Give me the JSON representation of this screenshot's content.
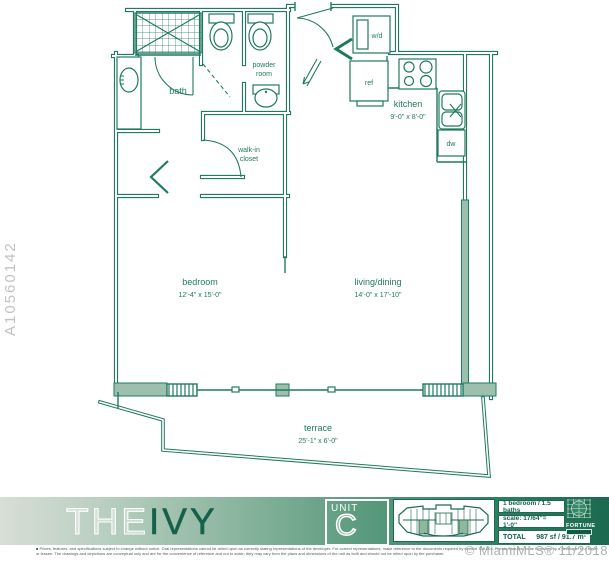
{
  "accent_color": "#1F7A5F",
  "wall_fill_color": "#9CC0AD",
  "plan": {
    "rooms": {
      "bath": {
        "label": "bath"
      },
      "powder": {
        "line1": "powder",
        "line2": "room"
      },
      "closet": {
        "line1": "walk-in",
        "line2": "closet"
      },
      "kitchen": {
        "label": "kitchen",
        "dims": "9'-0\" x 8'-0\""
      },
      "bedroom": {
        "label": "bedroom",
        "dims": "12'-4\" x 15'-0\""
      },
      "living": {
        "label": "living/dining",
        "dims": "14'-0\" x 17'-10\""
      },
      "terrace": {
        "label": "terrace",
        "dims": "25'-1\" x 6'-0\""
      }
    },
    "appliances": {
      "wd": "w/d",
      "ref": "ref",
      "dw": "dw"
    }
  },
  "footer": {
    "brand": {
      "the": "THE",
      "ivy": "IVY"
    },
    "unit": {
      "label": "UNIT",
      "letter": "C"
    },
    "stats": {
      "beds_baths": "1 bedroom / 1.5 baths",
      "scale": "scale: 17/64''= 1'-0''",
      "total_label": "TOTAL",
      "total_value": "987 sf / 91.7 m²"
    },
    "logo": {
      "name": "FORTUNE"
    },
    "disclaimer": "■ Prices, features, and specifications subject to change without notice. Oral representations cannot be relied upon as correctly stating representations of the developer. For correct representations, make reference to the documents required by section 718.503, Florida Statutes, to be furnished by a developer to a buyer or lessee. The drawings and depictions are conceptual only and are for the convenience of reference and not to scale; they may vary from the plans and dimensions of the unit as built and should not be relied upon by the purchaser."
  },
  "watermarks": {
    "listing_id": "A10560142",
    "mls": "© MiamiMLS® 11/2018"
  }
}
